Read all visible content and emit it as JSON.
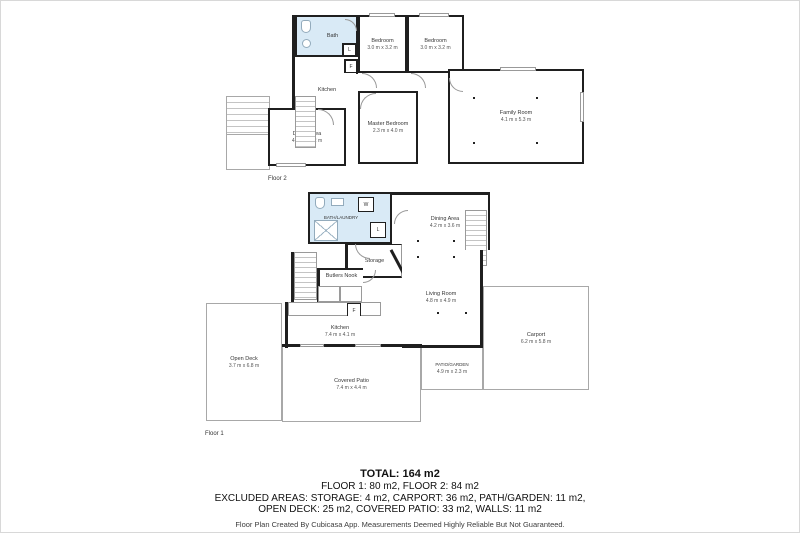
{
  "floor2": {
    "label": "Floor 2",
    "rooms": {
      "bath": {
        "name": "Bath",
        "dims": ""
      },
      "bedroom1": {
        "name": "Bedroom",
        "dims": "3.0 m x 3.2 m"
      },
      "bedroom2": {
        "name": "Bedroom",
        "dims": "3.0 m x 3.2 m"
      },
      "kitchen": {
        "name": "Kitchen",
        "dims": ""
      },
      "dining": {
        "name": "Dining Area",
        "dims": "4.8 m x 2.2 m"
      },
      "master": {
        "name": "Master Bedroom",
        "dims": "2.3 m x 4.0 m"
      },
      "family": {
        "name": "Family Room",
        "dims": "4.1 m x 5.3 m"
      }
    },
    "appliances": {
      "l": "L",
      "f": "F"
    }
  },
  "floor1": {
    "label": "Floor 1",
    "rooms": {
      "bathlaundry": {
        "name": "BATH/LAUNDRY",
        "dims": ""
      },
      "storage": {
        "name": "Storage",
        "dims": ""
      },
      "dining": {
        "name": "Dining Area",
        "dims": "4.2 m x 3.6 m"
      },
      "living": {
        "name": "Living Room",
        "dims": "4.8 m x 4.9 m"
      },
      "butlers": {
        "name": "Butlers Nook",
        "dims": ""
      },
      "kitchen": {
        "name": "Kitchen",
        "dims": "7.4 m x 4.1 m"
      },
      "opendeck": {
        "name": "Open Deck",
        "dims": "3.7 m x 6.8 m"
      },
      "coveredpatio": {
        "name": "Covered Patio",
        "dims": "7.4 m x 4.4 m"
      },
      "patiogarden": {
        "name": "PATIO/GARDEN",
        "dims": "4.9 m x 2.3 m"
      },
      "carport": {
        "name": "Carport",
        "dims": "6.2 m x 5.8 m"
      }
    },
    "appliances": {
      "w": "W",
      "l": "L",
      "f": "F"
    }
  },
  "summary": {
    "total": "TOTAL: 164 m2",
    "floors_line": "FLOOR 1: 80 m2, FLOOR 2: 84 m2",
    "excluded_line1": "EXCLUDED AREAS: STORAGE: 4 m2, CARPORT: 36 m2, PATH/GARDEN: 11 m2,",
    "excluded_line2": "OPEN DECK: 25 m2, COVERED PATIO: 33 m2, WALLS: 11 m2",
    "disclaimer": "Floor Plan Created By Cubicasa App. Measurements Deemed Highly Reliable But Not Guaranteed."
  },
  "colors": {
    "wall": "#1f1f1f",
    "bath_fill": "#d9eaf6",
    "outdoor_line": "#a8a8a8"
  }
}
